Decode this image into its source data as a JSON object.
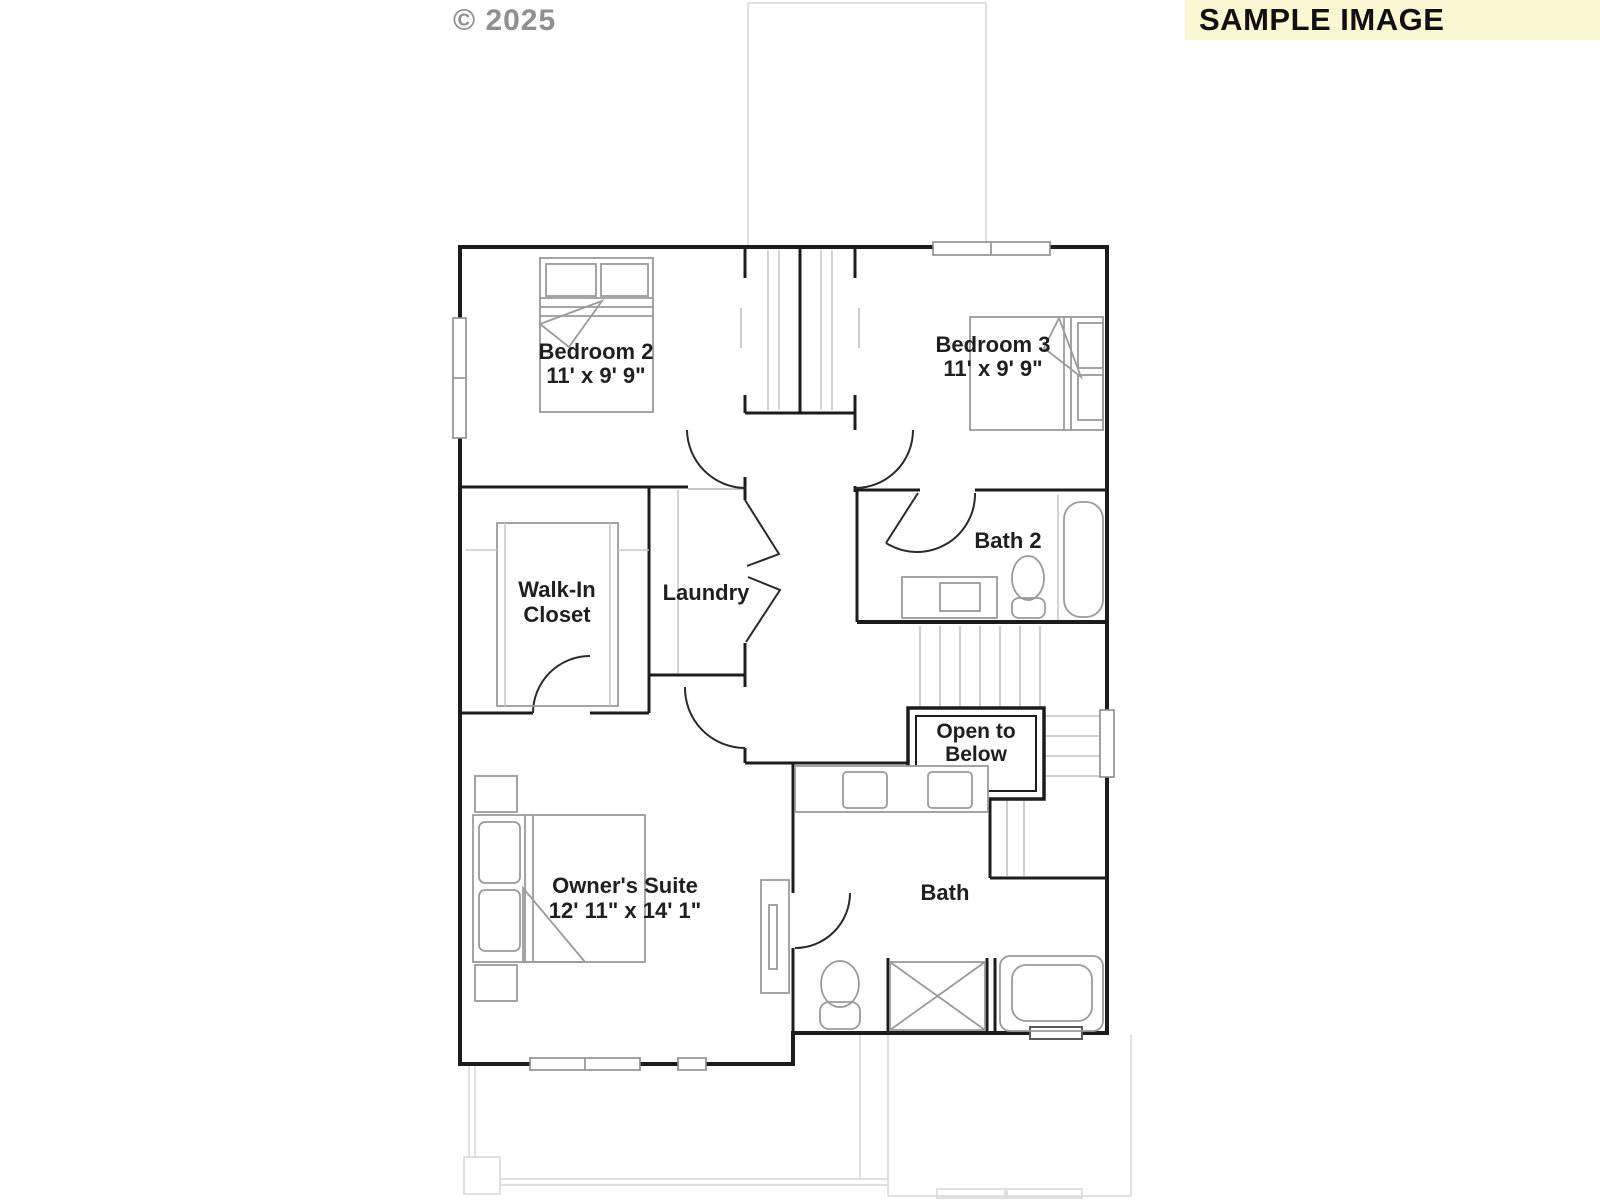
{
  "watermark": "© 2025",
  "banner": {
    "label": "SAMPLE IMAGE",
    "bg": "#FAF8D2",
    "fg": "#111111"
  },
  "colors": {
    "wall": "#1C1C1C",
    "fixture": "#9A9A9A",
    "ghost": "#DCDCDC",
    "text": "#1F1F1F"
  },
  "rooms": {
    "bedroom2": {
      "name": "Bedroom 2",
      "dims": "11' x 9' 9\""
    },
    "bedroom3": {
      "name": "Bedroom 3",
      "dims": "11' x 9' 9\""
    },
    "walk_in_closet": {
      "lines": [
        "Walk-In",
        "Closet"
      ]
    },
    "laundry": {
      "name": "Laundry"
    },
    "bath2": {
      "name": "Bath 2"
    },
    "open_to_below": {
      "lines": [
        "Open to",
        "Below"
      ]
    },
    "owners_suite": {
      "name": "Owner's Suite",
      "dims": "12' 11\" x 14' 1\""
    },
    "bath": {
      "name": "Bath"
    }
  },
  "fixtures": [
    "bed-icon",
    "pillow-icon",
    "nightstand-icon",
    "dresser-icon",
    "closet-shelves-icon",
    "bifold-door-icon",
    "vanity-sink-icon",
    "toilet-icon",
    "bathtub-icon",
    "shower-icon",
    "stairs-icon",
    "window-icon",
    "door-swing-icon"
  ]
}
